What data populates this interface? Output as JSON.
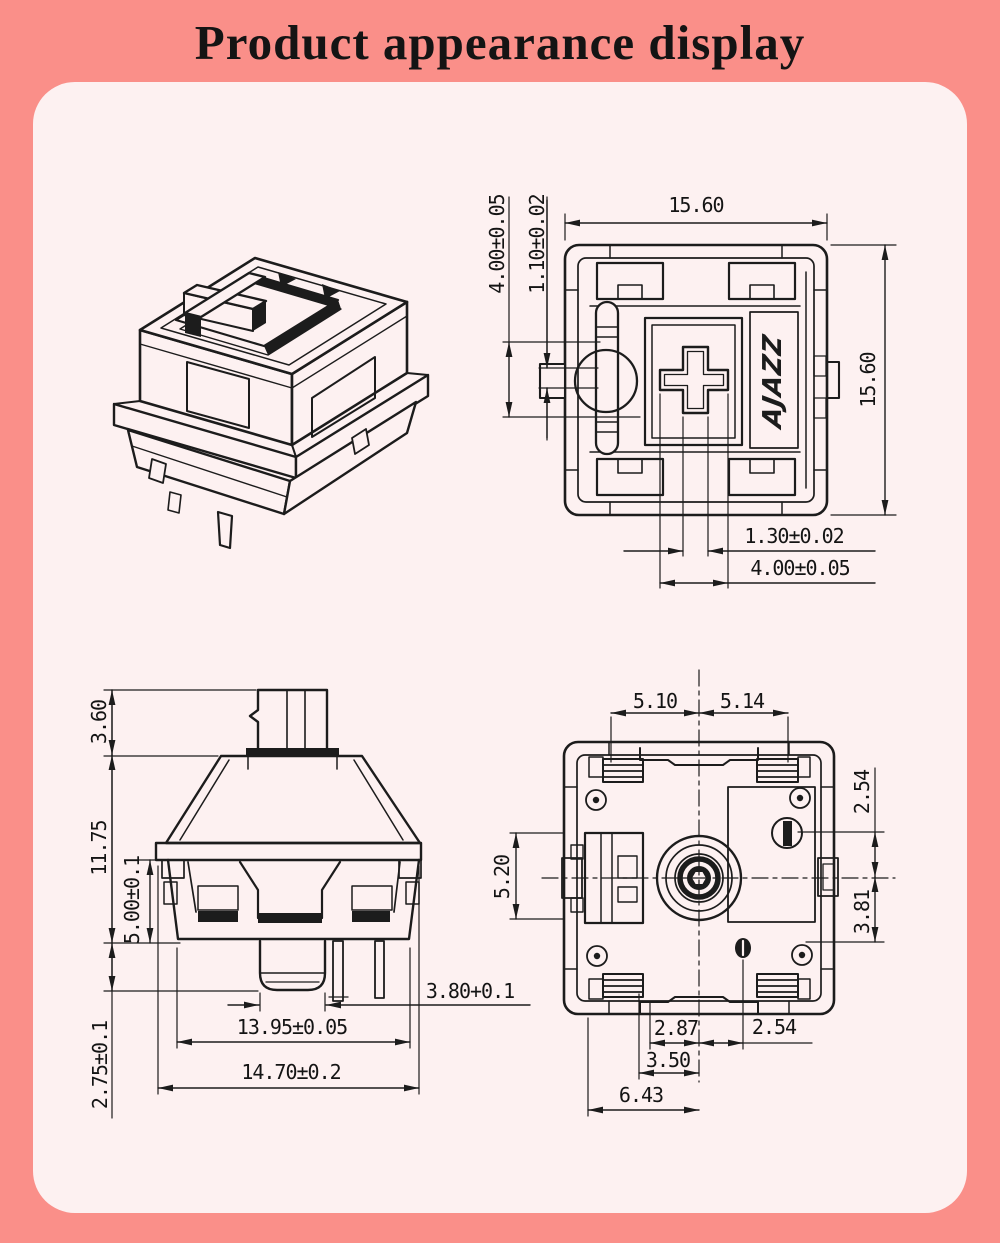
{
  "title": "Product appearance display",
  "colors": {
    "background": "#FA8F89",
    "panel": "#FDF1F1",
    "line": "#1C1C1C",
    "text": "#141414"
  },
  "views": {
    "top": {
      "dim_width": "15.60",
      "dim_height": "15.60",
      "dim_led_hole": "4.00±0.05",
      "dim_slot": "1.10±0.02",
      "dim_stem_thickness": "1.30±0.02",
      "dim_stem_cross": "4.00±0.05",
      "logo": "AJAZZ"
    },
    "front": {
      "dim_stem_height": "3.60",
      "dim_body_height": "11.75",
      "dim_lower_height": "5.00±0.1",
      "dim_post_height": "2.75±0.1",
      "dim_post_dia": "3.80+0.1",
      "dim_bottom_width": "13.95±0.05",
      "dim_flange_width": "14.70±0.2"
    },
    "bottom": {
      "dim_pin_left": "5.10",
      "dim_pin_right": "5.14",
      "dim_right_upper": "2.54",
      "dim_right_lower": "3.81",
      "dim_side": "5.20",
      "dim_bottom_1": "2.87",
      "dim_bottom_2": "2.54",
      "dim_bottom_3": "3.50",
      "dim_bottom_4": "6.43"
    }
  }
}
